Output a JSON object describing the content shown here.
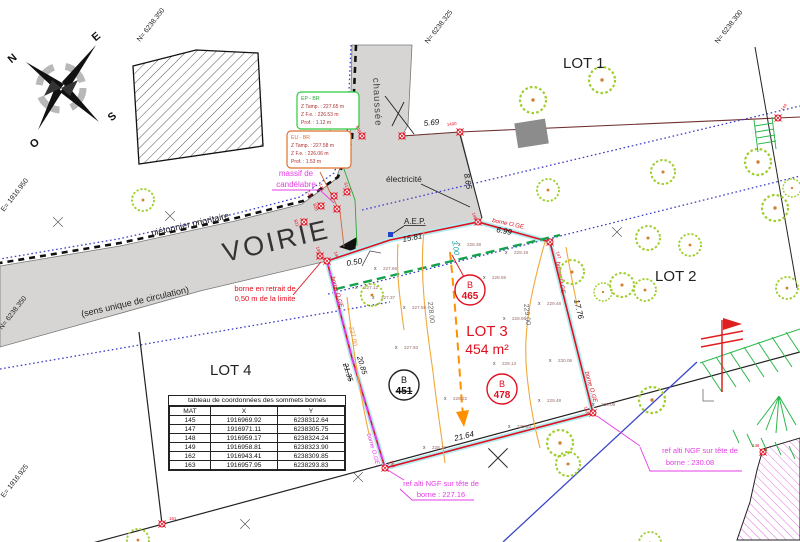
{
  "compass": {
    "n": "N",
    "e": "E",
    "s": "S",
    "w": "O"
  },
  "grid": {
    "top1": "N= 6238.350",
    "top2": "N= 6238.325",
    "top3": "N= 6238.300",
    "left1": "E= 1916.950",
    "left2": "N= 6238.350",
    "left3": "E= 1916.925"
  },
  "road": {
    "name": "VOIRIE",
    "surface": "chaussée",
    "pedestrian": "piétonnier prioritaire",
    "one_way": "(sens unique de circulation)"
  },
  "lots": {
    "lot1": "LOT 1",
    "lot2": "LOT 2",
    "lot3": "LOT 3",
    "lot3_area": "454 m²",
    "lot4": "LOT 4"
  },
  "dims": {
    "d569": "5.69",
    "p1400": "1400",
    "d865": "8.65",
    "d1581": "15.81",
    "d699": "6.99",
    "d300": "3.00",
    "d050": "0.50",
    "d2135": "21.35",
    "d2085": "20.85",
    "d2164": "21.64",
    "d1776": "17.76"
  },
  "contours": {
    "c227": "227.00",
    "c228": "228.00",
    "c229": "229.00"
  },
  "spots": [
    "227.66",
    "227.12",
    "227.37",
    "227.59",
    "227.93",
    "228.38",
    "228.55",
    "228.95",
    "229.19",
    "229.48",
    "229.13",
    "230.06",
    "228.22",
    "229.48",
    "229.20",
    "228.12",
    "230.09"
  ],
  "borne_oge": "borne O.GE.",
  "bornes": {
    "b144": "144",
    "b818": "818",
    "b821": "821",
    "b820": "820",
    "b128": "128",
    "b129": "129",
    "b617": "617",
    "b148": "148",
    "b149": "149",
    "b145": "145",
    "b147": "147",
    "b162": "162",
    "b163": "163",
    "b161": "161",
    "b146": "146"
  },
  "b_points": {
    "b465": {
      "letter": "B",
      "num": "465"
    },
    "b478": {
      "letter": "B",
      "num": "478"
    },
    "b451": {
      "letter": "B",
      "num": "451"
    }
  },
  "utilities": {
    "ep_box": {
      "title": "EP - BR",
      "l1": "Z Tamp. : 227.65 m",
      "l2": "Z F.e. :  226.53 m",
      "l3": "Prof. :    1.12 m"
    },
    "eu_box": {
      "title": "EU - BR",
      "l1": "Z Tamp. : 227.58 m",
      "l2": "Z F.e. :  226.06 m",
      "l3": "Prof. :    1.53 m"
    },
    "massif1": "massif de",
    "massif2": "candélabre",
    "electricite": "électricité",
    "aep": "A.E.P."
  },
  "notes": {
    "retrait1": "borne en retrait de",
    "retrait2": "0,50 m de la limite",
    "ref1a": "ref alti NGF sur tête de",
    "ref1b": "borne : 227.16",
    "ref2a": "ref alti NGF sur tête de",
    "ref2b": "borne : 230.08"
  },
  "table": {
    "title": "tableau de coordonnées des sommets bornés",
    "headers": [
      "MAT",
      "X",
      "Y"
    ],
    "rows": [
      [
        "145",
        "1916969.92",
        "6238312.64"
      ],
      [
        "147",
        "1916971.11",
        "6238305.75"
      ],
      [
        "148",
        "1916959.17",
        "6238324.24"
      ],
      [
        "149",
        "1916958.81",
        "6238323.90"
      ],
      [
        "162",
        "1916943.41",
        "6238309.85"
      ],
      [
        "163",
        "1916957.95",
        "6238293.83"
      ]
    ]
  },
  "colors": {
    "boundary_red": "#e01020",
    "magenta": "#e63ce6",
    "blue_dotted": "#4040c8",
    "green_dashed": "#14a24c",
    "contour_orange": "#f0a83a",
    "cyan_band": "#b3ecef",
    "road_gray": "#d7d5d3"
  }
}
